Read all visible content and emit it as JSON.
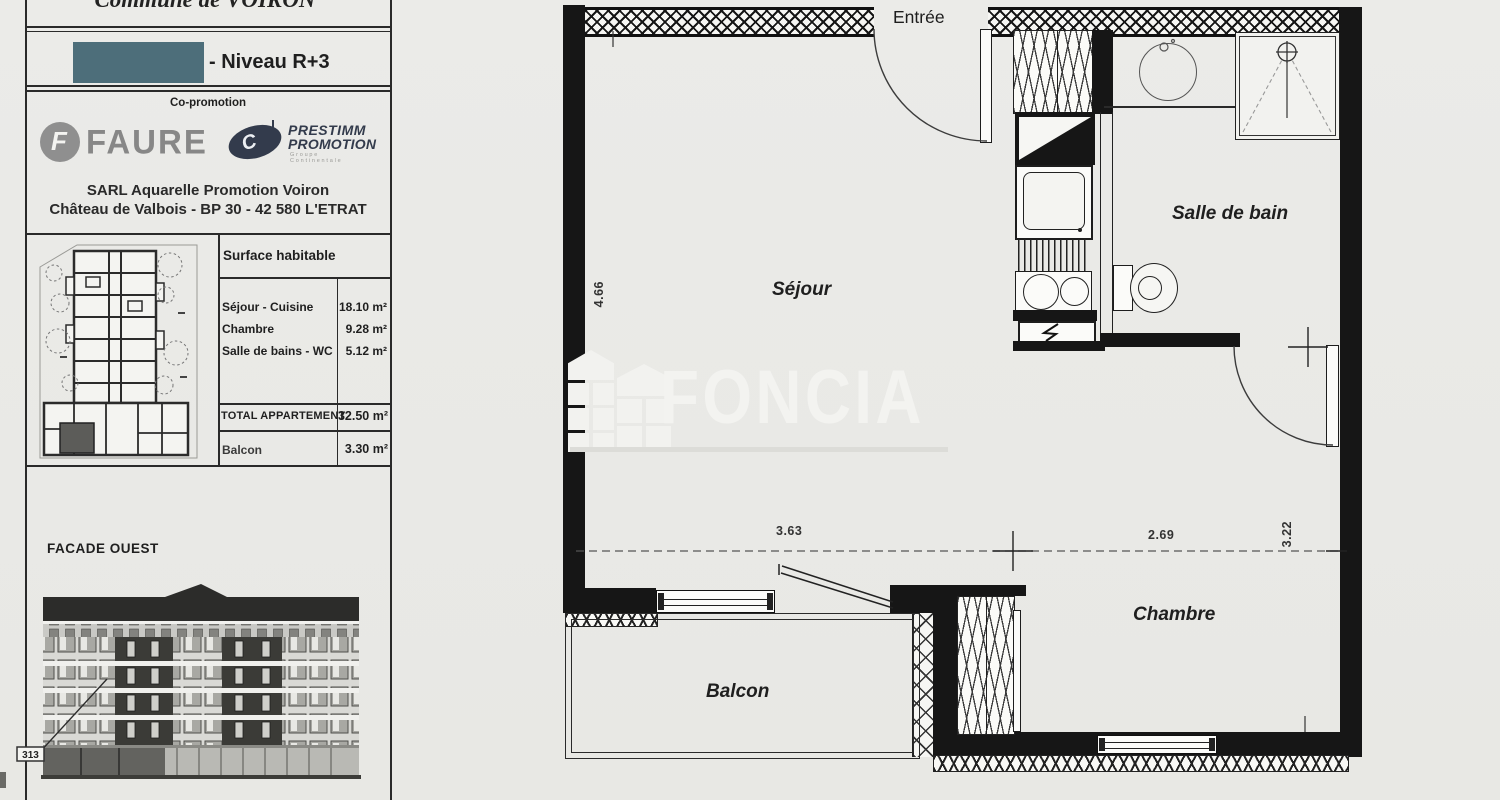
{
  "header": {
    "commune": "Commune de VOIRON",
    "level": "- Niveau R+3",
    "co_promotion_label": "Co-promotion",
    "brand_faure": "FAURE",
    "brand_faure_glyph": "F",
    "brand_prestimm_glyph": "C",
    "brand_prestimm_line1": "PRESTIMM",
    "brand_prestimm_line2": "PROMOTION",
    "brand_prestimm_subtext": "Groupe Continentale",
    "address_line1": "SARL Aquarelle Promotion Voiron",
    "address_line2": "Château de Valbois - BP 30 - 42 580 L'ETRAT"
  },
  "surface_table": {
    "title": "Surface habitable",
    "rows": [
      {
        "label": "Séjour - Cuisine",
        "value": "18.10 m²"
      },
      {
        "label": "Chambre",
        "value": "9.28 m²"
      },
      {
        "label": "Salle de bains - WC",
        "value": "5.12 m²"
      }
    ],
    "total_label": "TOTAL APPARTEMENT",
    "total_value": "32.50 m²",
    "balcon_label": "Balcon",
    "balcon_value": "3.30 m²"
  },
  "facade": {
    "title": "FACADE OUEST",
    "unit_ref": "313"
  },
  "floor_plan": {
    "rooms": {
      "entree": "Entrée",
      "sejour": "Séjour",
      "salle_de_bain": "Salle de bain",
      "chambre": "Chambre",
      "balcon": "Balcon"
    },
    "dimensions": {
      "sejour_depth": "4.66",
      "sejour_width": "3.63",
      "chambre_width": "2.69",
      "chambre_depth": "3.22"
    }
  },
  "watermark": {
    "brand": "FONCIA"
  },
  "colors": {
    "redaction_box": "#4d6e7a",
    "paper": "#eaeae7",
    "ink": "#1c1c1c",
    "logo_gray": "#8f8f8f",
    "logo_navy": "#333b4c"
  }
}
